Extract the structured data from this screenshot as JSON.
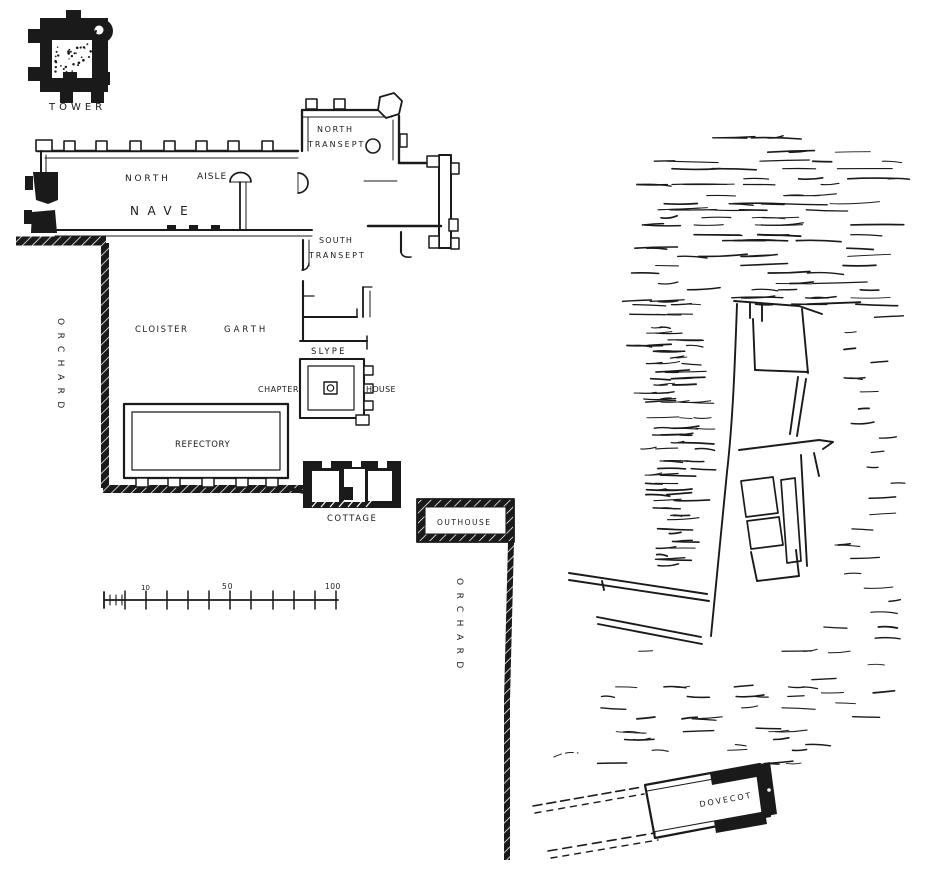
{
  "colors": {
    "ink": "#1a1a1a",
    "paper": "#ffffff"
  },
  "plan": {
    "type": "monastic-site-plan",
    "labels": [
      {
        "id": "tower",
        "text": "TOWER",
        "x": 49,
        "y": 110,
        "fs": 10,
        "ls": 4
      },
      {
        "id": "north-aisle-word1",
        "text": "NORTH",
        "x": 125,
        "y": 181,
        "fs": 9,
        "ls": 2.8
      },
      {
        "id": "north-aisle-word2",
        "text": "AISLE",
        "x": 197,
        "y": 179,
        "fs": 9,
        "ls": 1
      },
      {
        "id": "nave",
        "text": "NAVE",
        "x": 130,
        "y": 215,
        "fs": 12,
        "ls": 8.5
      },
      {
        "id": "north-transept-word1",
        "text": "NORTH",
        "x": 317,
        "y": 132,
        "fs": 8,
        "ls": 1.7
      },
      {
        "id": "north-transept-word2",
        "text": "TRANSEPT",
        "x": 308,
        "y": 147,
        "fs": 8,
        "ls": 2
      },
      {
        "id": "south-transept-word1",
        "text": "SOUTH",
        "x": 319,
        "y": 243,
        "fs": 8,
        "ls": 1.2
      },
      {
        "id": "south-transept-word2",
        "text": "TRANSEPT",
        "x": 309,
        "y": 258,
        "fs": 8,
        "ls": 1.9
      },
      {
        "id": "cloister",
        "text": "CLOISTER",
        "x": 135,
        "y": 332,
        "fs": 8.5,
        "ls": 1.5
      },
      {
        "id": "garth",
        "text": "GARTH",
        "x": 224,
        "y": 332,
        "fs": 8.5,
        "ls": 3
      },
      {
        "id": "slype",
        "text": "SLYPE",
        "x": 311,
        "y": 354,
        "fs": 8.5,
        "ls": 2.2
      },
      {
        "id": "chapter",
        "text": "CHAPTER",
        "x": 258,
        "y": 392,
        "fs": 8,
        "ls": 0.5
      },
      {
        "id": "house",
        "text": "HOUSE",
        "x": 366,
        "y": 392,
        "fs": 8,
        "ls": 0.3
      },
      {
        "id": "refectory",
        "text": "REFECTORY",
        "x": 175,
        "y": 447,
        "fs": 8.5,
        "ls": 0.6
      },
      {
        "id": "cottage",
        "text": "COTTAGE",
        "x": 327,
        "y": 521,
        "fs": 8.5,
        "ls": 1.5
      },
      {
        "id": "outhouse",
        "text": "OUTHOUSE",
        "x": 437,
        "y": 525,
        "fs": 7.5,
        "ls": 1.5
      },
      {
        "id": "orchard-west",
        "text": "ORCHARD",
        "x": 58,
        "y": 318,
        "fs": 9,
        "ls": 7.5,
        "rot": 90
      },
      {
        "id": "orchard-east",
        "text": "ORCHARD",
        "x": 457,
        "y": 578,
        "fs": 9,
        "ls": 7.5,
        "rot": 90
      },
      {
        "id": "dovecot",
        "text": "DOVECOT",
        "x": 700,
        "y": 807,
        "fs": 8,
        "ls": 2,
        "rot": -10
      },
      {
        "id": "scale-10",
        "text": "10",
        "x": 141,
        "y": 590,
        "fs": 7,
        "ls": 0
      },
      {
        "id": "scale-50",
        "text": "50",
        "x": 222,
        "y": 589,
        "fs": 7.5,
        "ls": 1
      },
      {
        "id": "scale-100",
        "text": "100",
        "x": 325,
        "y": 589,
        "fs": 7.5,
        "ls": 0.5
      }
    ],
    "scale_bar": {
      "tick_labels": [
        "10",
        "50",
        "100"
      ],
      "range": "0-100"
    }
  }
}
